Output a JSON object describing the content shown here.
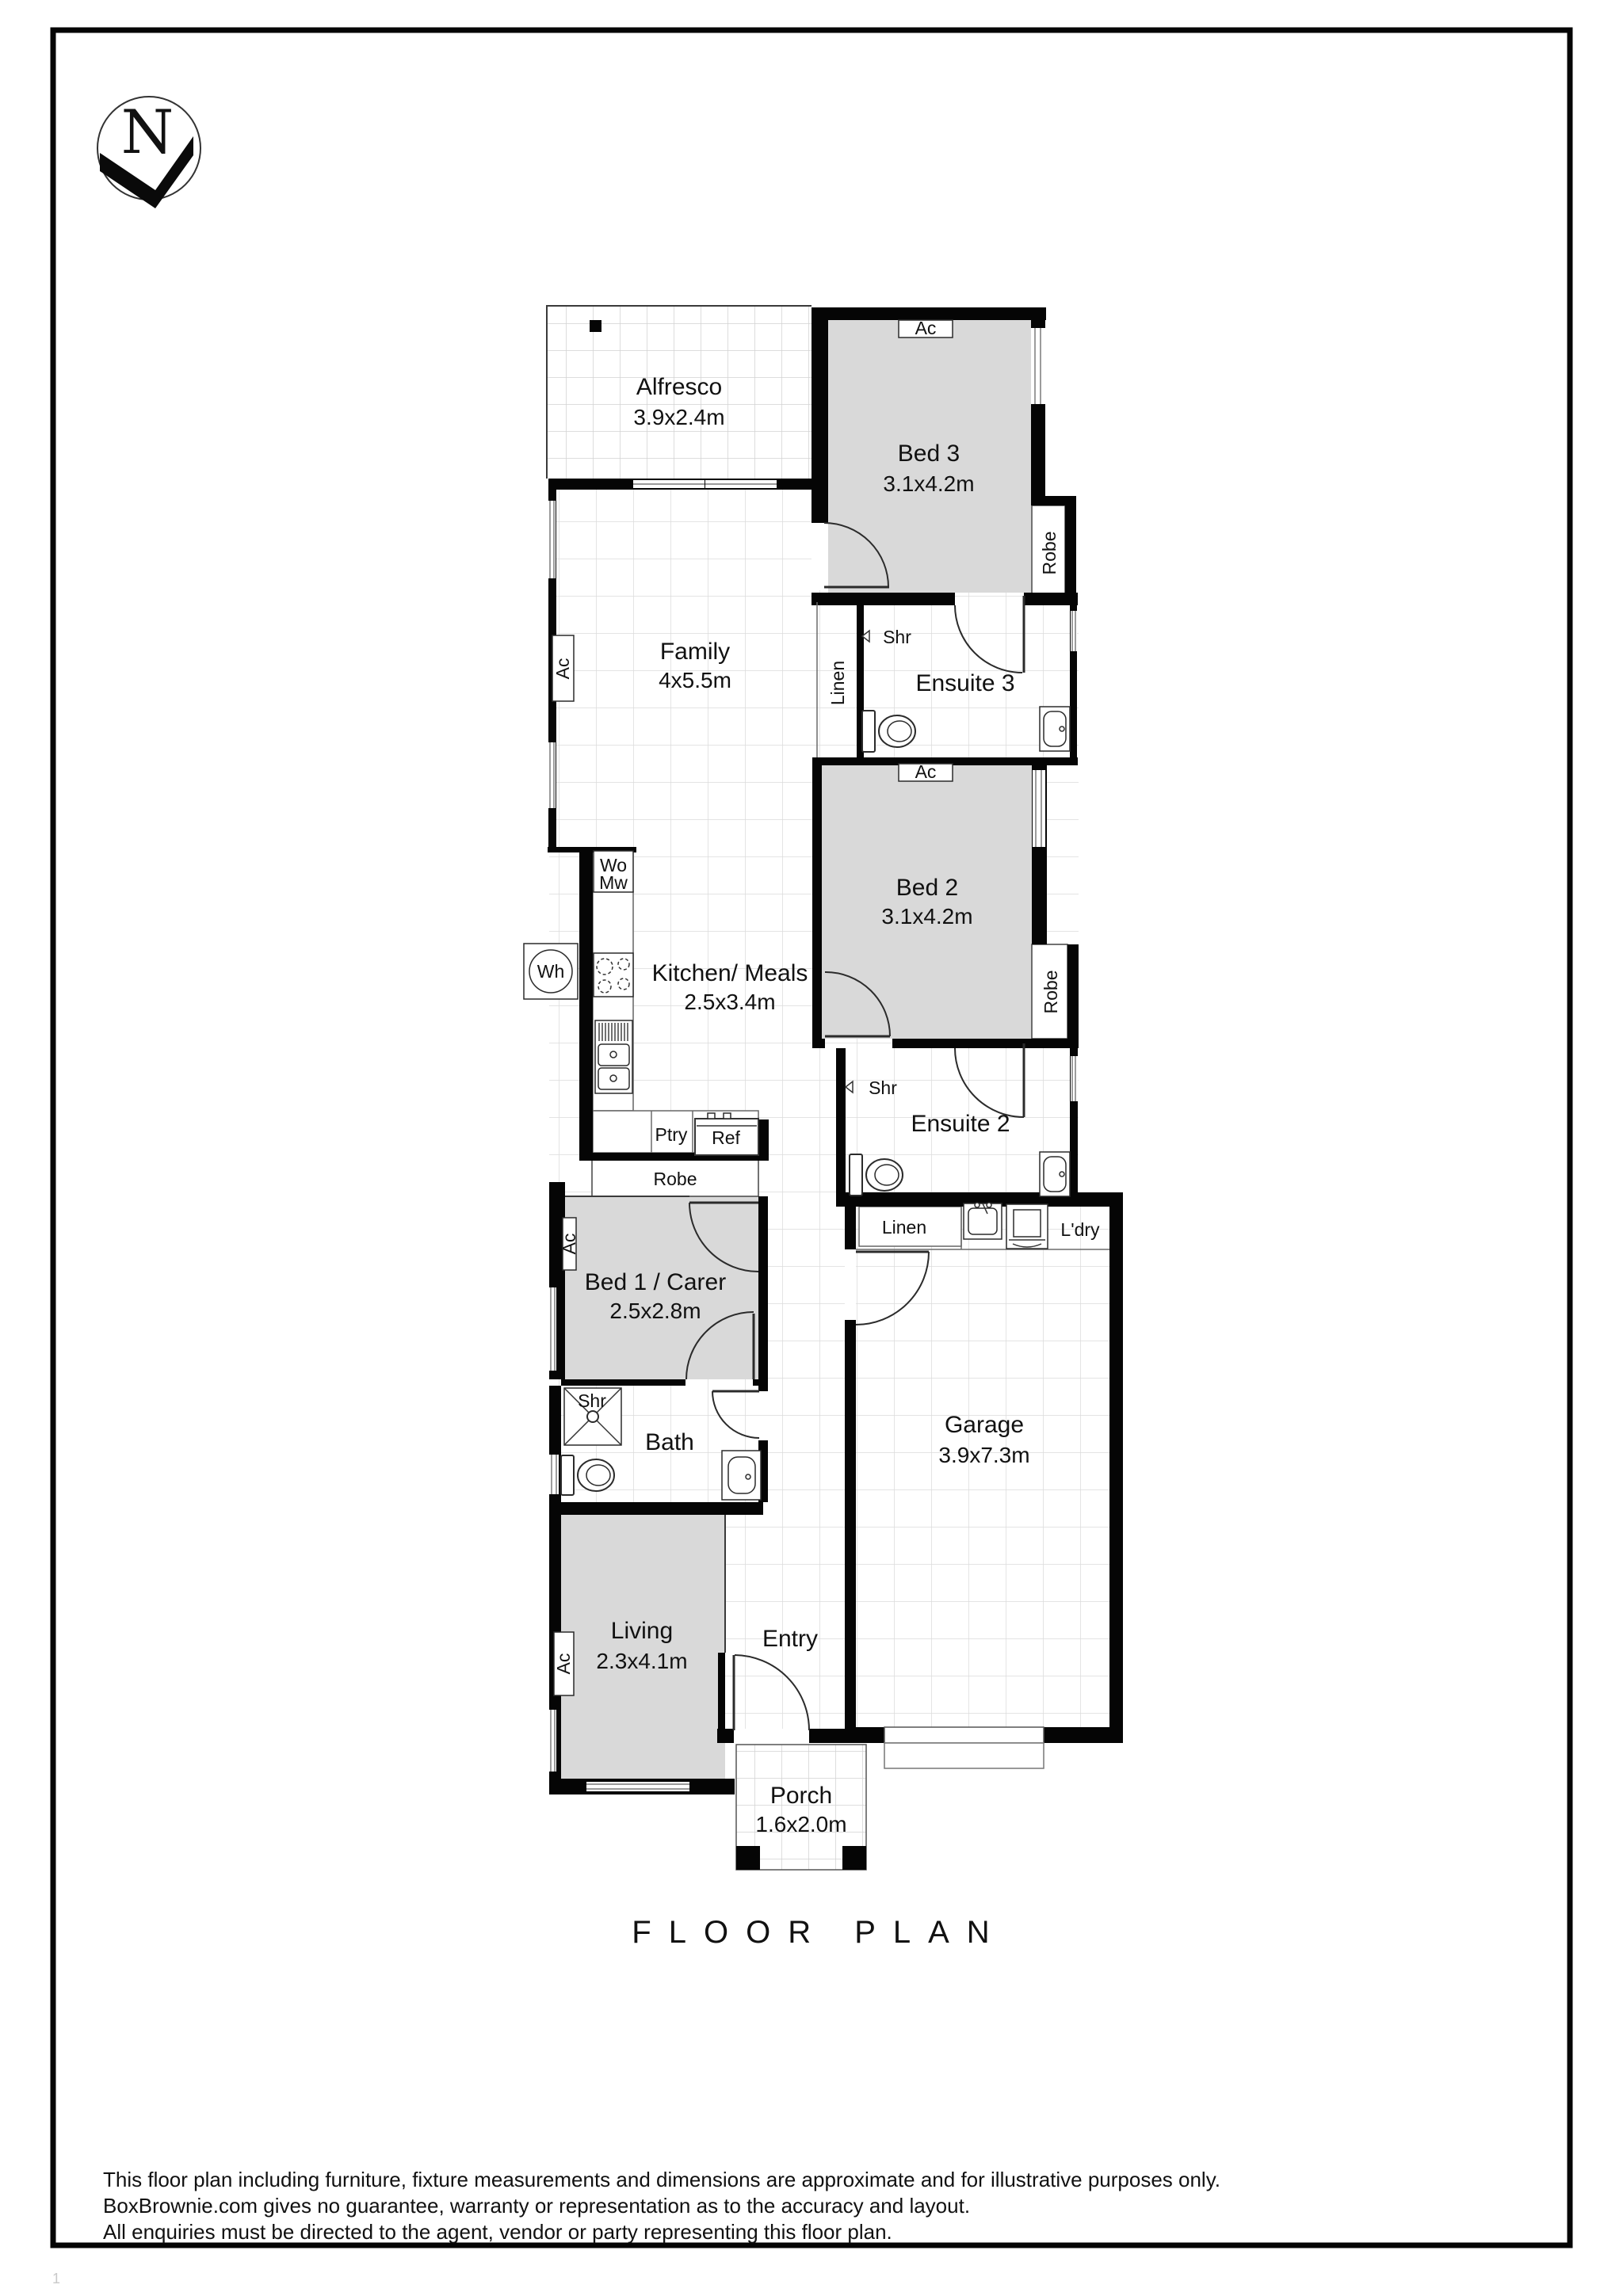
{
  "page": {
    "floor_plan_title": "FLOOR PLAN",
    "north_letter": "N",
    "page_mark": "1"
  },
  "rooms": {
    "alfresco": {
      "name": "Alfresco",
      "dims": "3.9x2.4m"
    },
    "bed3": {
      "name": "Bed 3",
      "dims": "3.1x4.2m"
    },
    "family": {
      "name": "Family",
      "dims": "4x5.5m"
    },
    "ensuite3": {
      "name": "Ensuite 3"
    },
    "bed2": {
      "name": "Bed 2",
      "dims": "3.1x4.2m"
    },
    "kitchen": {
      "name": "Kitchen/ Meals",
      "dims": "2.5x3.4m"
    },
    "ensuite2": {
      "name": "Ensuite 2"
    },
    "bed1": {
      "name": "Bed 1 / Carer",
      "dims": "2.5x2.8m"
    },
    "bath": {
      "name": "Bath"
    },
    "garage": {
      "name": "Garage",
      "dims": "3.9x7.3m"
    },
    "living": {
      "name": "Living",
      "dims": "2.3x4.1m"
    },
    "entry": {
      "name": "Entry"
    },
    "porch": {
      "name": "Porch",
      "dims": "1.6x2.0m"
    }
  },
  "fixtures": {
    "ac": "Ac",
    "robe": "Robe",
    "linen": "Linen",
    "shr": "Shr",
    "wo": "Wo",
    "mw": "Mw",
    "wh": "Wh",
    "ptry": "Ptry",
    "ref": "Ref",
    "ldry": "L'dry"
  },
  "disclaimer": {
    "line1": "This floor plan including furniture, fixture measurements and dimensions are approximate and for illustrative purposes only.",
    "line2": "BoxBrownie.com gives no guarantee, warranty or representation as to the accuracy and layout.",
    "line3": "All enquiries must be directed to the agent, vendor or party representing this floor plan."
  },
  "colors": {
    "wall": "#050505",
    "room_fill": "#d9d9d9",
    "grid_small": "#d2d2d2",
    "grid_large": "#dcdcdc"
  }
}
